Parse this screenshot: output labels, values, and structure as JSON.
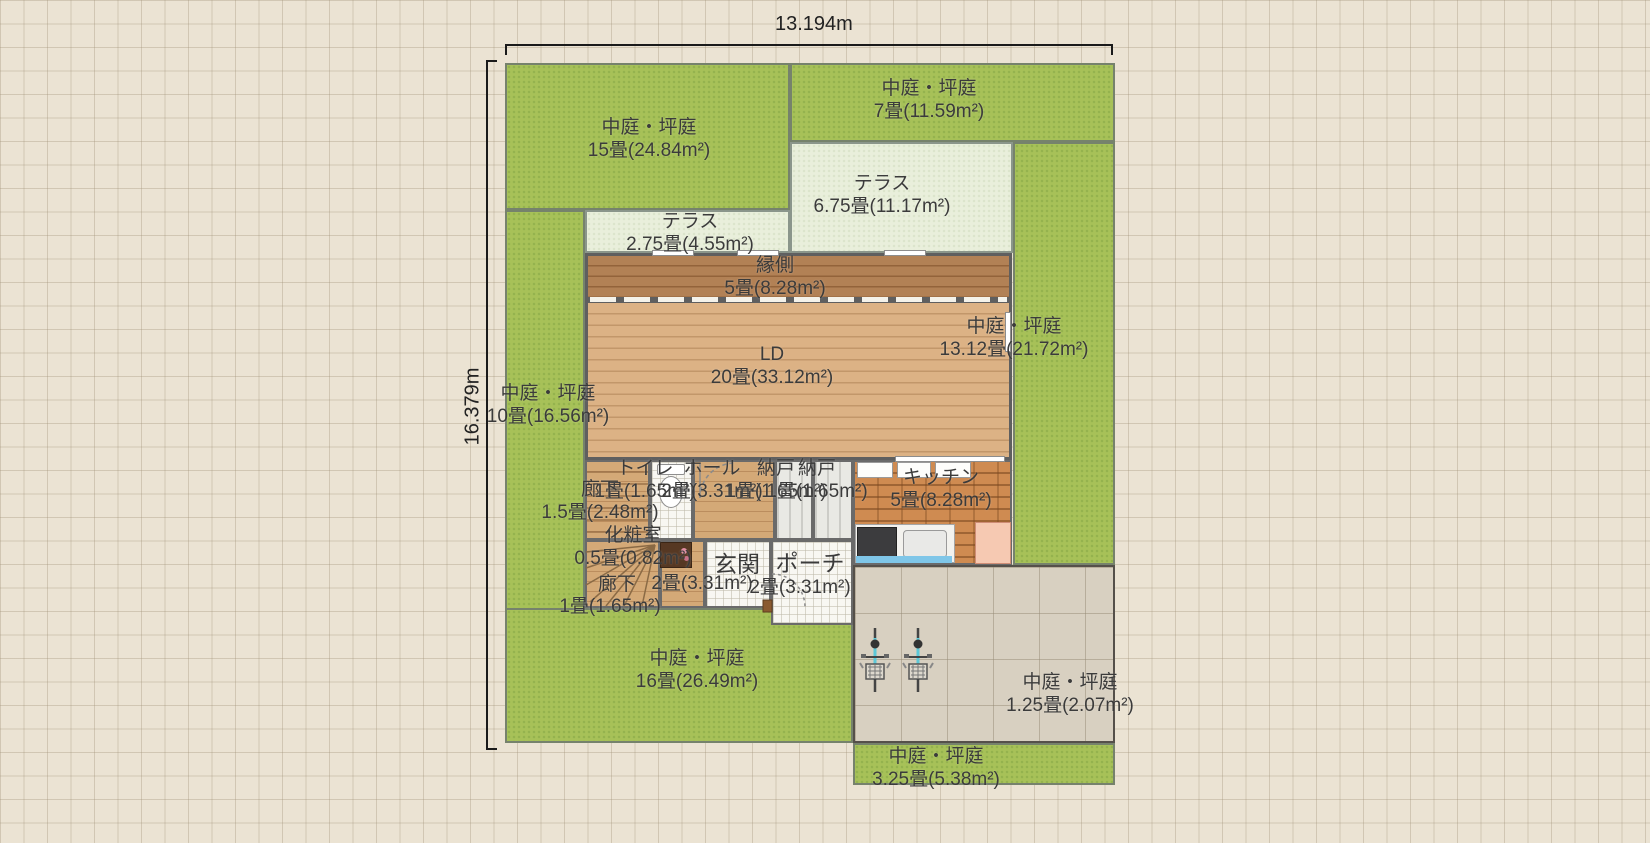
{
  "dimensions": {
    "width_label": "13.194m",
    "height_label": "16.379m"
  },
  "regions": {
    "garden_15": {
      "name": "中庭・坪庭",
      "area": "15畳(24.84m²)"
    },
    "garden_7": {
      "name": "中庭・坪庭",
      "area": "7畳(11.59m²)"
    },
    "terrace_675": {
      "name": "テラス",
      "area": "6.75畳(11.17m²)"
    },
    "terrace_275": {
      "name": "テラス",
      "area": "2.75畳(4.55m²)"
    },
    "engawa": {
      "name": "縁側",
      "area": "5畳(8.28m²)"
    },
    "ld": {
      "name": "LD",
      "area": "20畳(33.12m²)"
    },
    "garden_1312": {
      "name": "中庭・坪庭",
      "area": "13.12畳(21.72m²)"
    },
    "garden_10": {
      "name": "中庭・坪庭",
      "area": "10畳(16.56m²)"
    },
    "toilet": {
      "name": "トイレ",
      "area": "1畳(1.65m²)"
    },
    "hall": {
      "name": "ホール",
      "area": "2畳(3.31m²)"
    },
    "storage_a": {
      "name": "納戸",
      "area": "1畳(1.65m²)"
    },
    "storage_b": {
      "name": "納戸",
      "area": "1畳(1.65m²)"
    },
    "kitchen": {
      "name": "キッチン",
      "area": "5畳(8.28m²)"
    },
    "corridor_a": {
      "name": "廊下",
      "area": "1.5畳(2.48m²)"
    },
    "powder": {
      "name": "化粧室",
      "area": "0.5畳(0.82m²)"
    },
    "entrance": {
      "name": "玄関",
      "area": "2畳(3.31m²)"
    },
    "porch": {
      "name": "ポーチ",
      "area": "2畳(3.31m²)"
    },
    "corridor_b": {
      "name": "廊下",
      "area": "1畳(1.65m²)"
    },
    "garden_16": {
      "name": "中庭・坪庭",
      "area": "16畳(26.49m²)"
    },
    "garden_125": {
      "name": "中庭・坪庭",
      "area": "1.25畳(2.07m²)"
    },
    "garden_325": {
      "name": "中庭・坪庭",
      "area": "3.25畳(5.38m²)"
    }
  },
  "icons": {
    "bicycle_count": 2,
    "names": [
      "toilet-icon",
      "vanity-icon",
      "stove-icon",
      "sink-icon",
      "fridge-icon",
      "wall-cabinet-icon",
      "stairs-icon",
      "bicycle-icon",
      "door-arc-icon"
    ]
  },
  "colors": {
    "garden_green": "#a7c158",
    "terrace_pale": "#e9efdb",
    "engawa_wood": "#b28155",
    "ld_wood": "#dcb285",
    "kitchen_brick": "#cf8b51",
    "driveway": "#d8d0c1",
    "background": "#ebe3d3",
    "wall": "#5f5f5f",
    "label_text": "#3b3b3b",
    "bicycle_frame": "#5cc8d8"
  }
}
